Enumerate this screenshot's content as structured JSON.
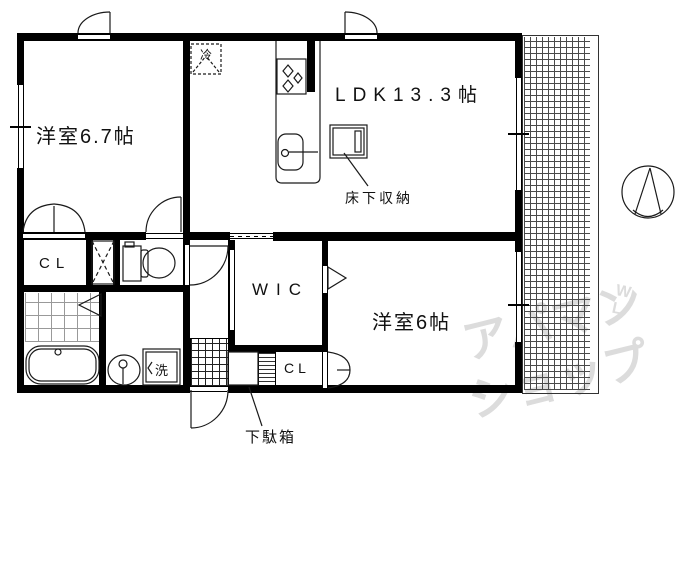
{
  "rooms": {
    "bedroom1": {
      "label": "洋室6.7帖"
    },
    "ldk": {
      "label": "LDK13.3帖"
    },
    "floor_storage": {
      "label": "床下収納"
    },
    "wic": {
      "label": "WIC"
    },
    "bedroom2": {
      "label": "洋室6帖"
    },
    "closet1": {
      "label": "CL"
    },
    "closet2": {
      "label": "CL"
    },
    "shoe_cabinet": {
      "label": "下駄箱"
    },
    "refrigerator": {
      "label": "冷"
    },
    "washing_machine": {
      "label": "洗"
    }
  },
  "watermark": {
    "line1": "アパマン",
    "line2": "ショップ",
    "marks": "W\nL\n°"
  },
  "colors": {
    "line": "#000000",
    "watermark": "#dcdcdc",
    "background": "#ffffff"
  }
}
